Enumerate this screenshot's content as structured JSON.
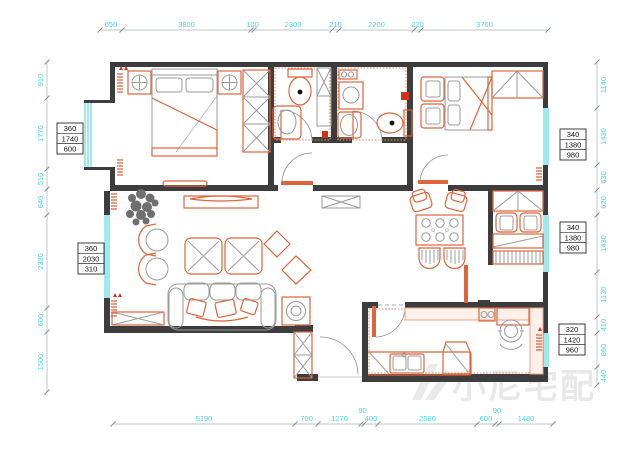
{
  "title": "apartment-floor-plan-cad-drawing",
  "colors": {
    "dimension_text": "#46d7e0",
    "window_glass": "#3fd6de",
    "wall": "#3d3d3d",
    "furniture_accent": "#e0643a",
    "furniture_gray": "#9b9b9b",
    "watermark": "#e8e8e8"
  },
  "dimensions": {
    "top": [
      "650",
      "3800",
      "100",
      "2300",
      "210",
      "2200",
      "220",
      "3760"
    ],
    "bottom": [
      "5190",
      "700",
      "1270",
      "90",
      "400",
      "2580",
      "600",
      "90",
      "1480"
    ],
    "left": [
      "910",
      "1770",
      "510",
      "640",
      "2330",
      "600",
      "1500"
    ],
    "right": [
      "1140",
      "1430",
      "630",
      "620",
      "1430",
      "1130",
      "410",
      "860",
      "440"
    ]
  },
  "window_callouts": [
    {
      "id": "left-upper",
      "values": [
        "360",
        "1740",
        "600"
      ]
    },
    {
      "id": "left-lower",
      "values": [
        "360",
        "2030",
        "310"
      ]
    },
    {
      "id": "right-upper",
      "values": [
        "340",
        "1380",
        "980"
      ]
    },
    {
      "id": "right-middle",
      "values": [
        "340",
        "1380",
        "980"
      ]
    },
    {
      "id": "right-lower",
      "values": [
        "320",
        "1420",
        "960"
      ]
    }
  ],
  "watermark": {
    "text": "小尼宅配"
  }
}
